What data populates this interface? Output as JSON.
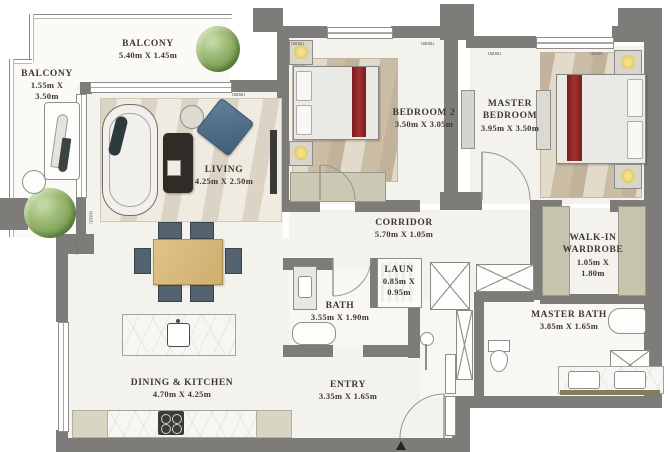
{
  "plan_type": "apartment floor plan",
  "rooms": [
    {
      "id": "balcony-top",
      "name": "BALCONY",
      "dims": "5.40m X 1.45m"
    },
    {
      "id": "balcony-left",
      "name": "BALCONY",
      "dims": "1.55m X",
      "dims2": "3.50m"
    },
    {
      "id": "living",
      "name": "LIVING",
      "dims": "4.25m X 2.50m"
    },
    {
      "id": "bedroom-2",
      "name": "BEDROOM 2",
      "dims": "3.50m X 3.05m"
    },
    {
      "id": "master-bedroom",
      "name": "MASTER",
      "name2": "BEDROOM",
      "dims": "3.95m X 3.50m"
    },
    {
      "id": "corridor",
      "name": "CORRIDOR",
      "dims": "5.70m X 1.05m"
    },
    {
      "id": "walkin-wardrobe",
      "name": "WALK-IN",
      "name2": "WARDROBE",
      "dims": "1.05m X",
      "dims2": "1.80m"
    },
    {
      "id": "laundry",
      "name": "LAUN",
      "dims": "0.85m X",
      "dims2": "0.95m"
    },
    {
      "id": "bath",
      "name": "BATH",
      "dims": "3.55m X 1.90m"
    },
    {
      "id": "master-bath",
      "name": "MASTER BATH",
      "dims": "3.85m X 1.65m"
    },
    {
      "id": "dining-kitchen",
      "name": "DINING & KITCHEN",
      "dims": "4.70m X 4.25m"
    },
    {
      "id": "entry",
      "name": "ENTRY",
      "dims": "3.35m X 1.65m"
    }
  ],
  "colors": {
    "wall": "#7d7c78",
    "floor": "#f4f2ed",
    "bed_throw_red": "#8e2424",
    "plant_green": "#8fae6c",
    "armchair_blue": "#4f6d88",
    "table_wood": "#d8b97c",
    "wardrobe_sage": "#c7c4ad",
    "label_text": "#3e3831"
  }
}
